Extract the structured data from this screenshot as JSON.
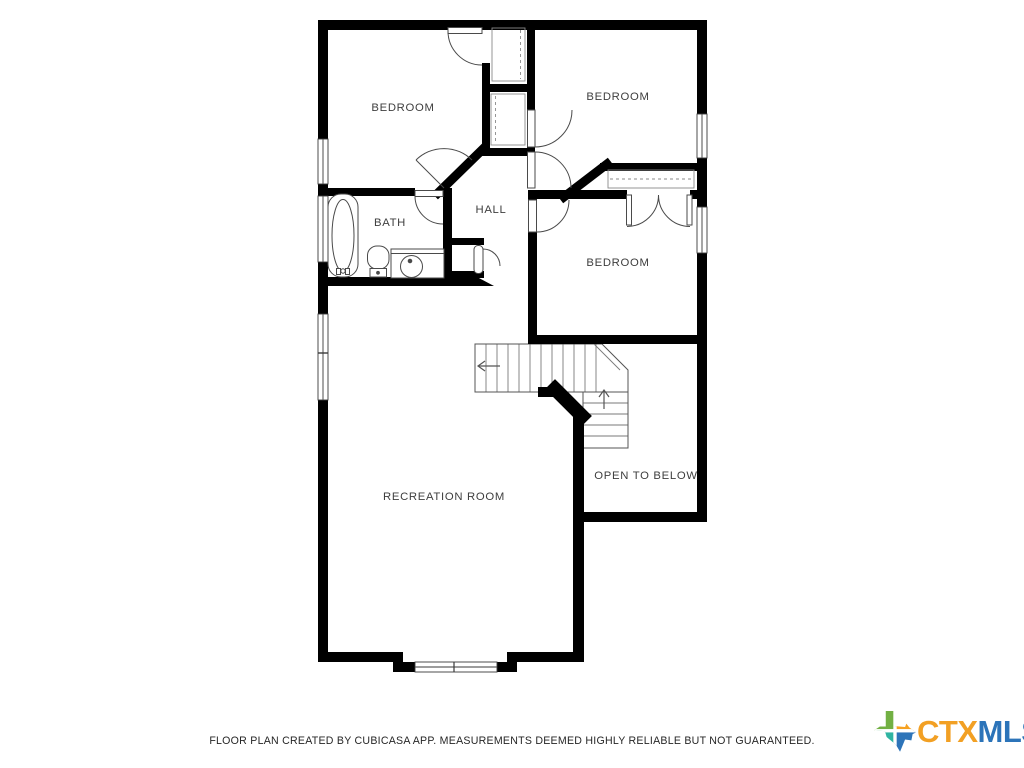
{
  "floorplan": {
    "rooms": {
      "bedroom_top_left": {
        "label": "BEDROOM"
      },
      "bedroom_top_right": {
        "label": "BEDROOM"
      },
      "bedroom_middle": {
        "label": "BEDROOM"
      },
      "bath": {
        "label": "BATH"
      },
      "hall": {
        "label": "HALL"
      },
      "recreation_room": {
        "label": "RECREATION ROOM"
      },
      "open_to_below": {
        "label": "OPEN TO BELOW"
      }
    },
    "colors": {
      "wall": "#000000",
      "thin_line": "#4a4a4a",
      "label_text": "#3e3e3e",
      "background": "#ffffff"
    }
  },
  "footer": {
    "disclaimer": "FLOOR PLAN CREATED BY CUBICASA APP. MEASUREMENTS DEEMED HIGHLY RELIABLE BUT NOT GUARANTEED."
  },
  "logo": {
    "ctx": "CTX",
    "mls": "MLS",
    "colors": {
      "ctx_text": "#F2A024",
      "mls_text": "#2C74B9",
      "texas_green": "#72B043",
      "texas_orange": "#F6A221",
      "texas_teal": "#2FB4A2",
      "texas_blue": "#2D74B9"
    }
  }
}
